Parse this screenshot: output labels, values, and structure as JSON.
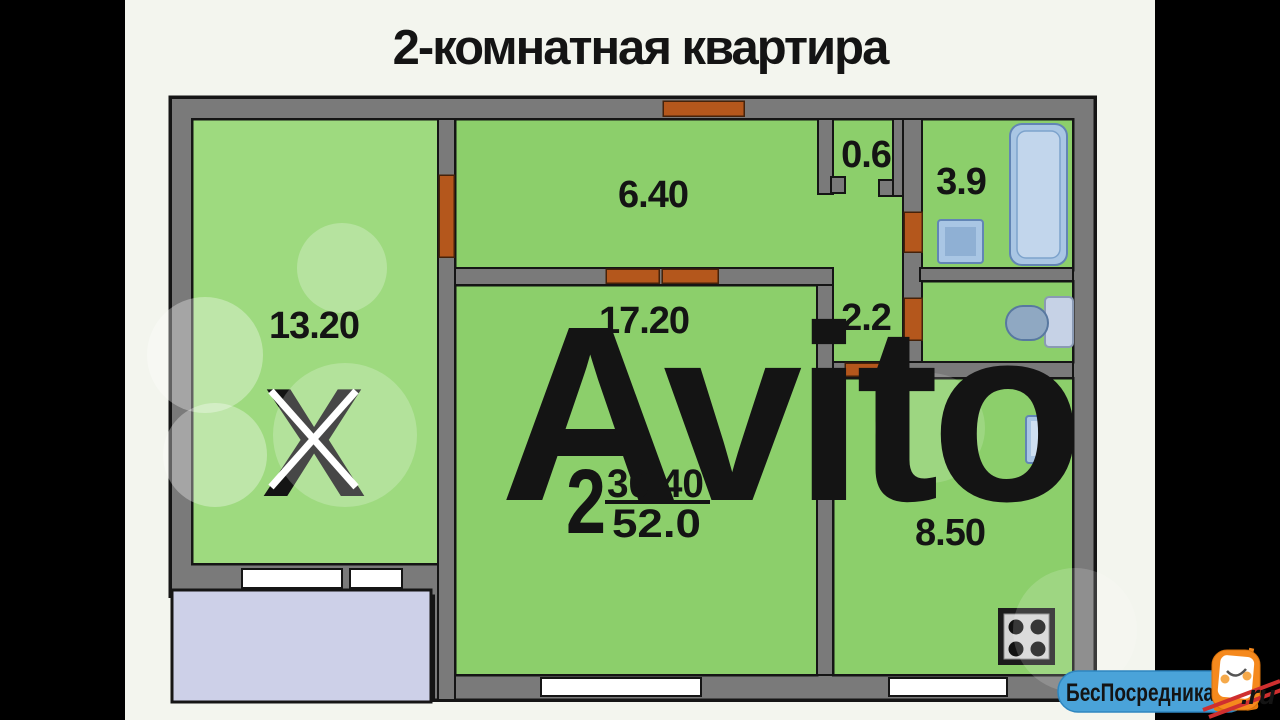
{
  "title": "2-комнатная квартира",
  "plan": {
    "rooms": {
      "living_room_1": {
        "label": "13.20"
      },
      "hallway": {
        "label": "6.40"
      },
      "living_room_2": {
        "label": "17.20"
      },
      "closet": {
        "label": "0.6"
      },
      "bathroom": {
        "label": "3.9"
      },
      "wc": {
        "label": "2.2"
      },
      "kitchen": {
        "label": "8.50"
      }
    },
    "summary": {
      "rooms_count": "2",
      "living_area": "30.40",
      "total_area": "52.0"
    }
  },
  "watermark": {
    "text": "Avito"
  },
  "logo": {
    "site_name": "БесПосредника",
    "domain_suffix": ".ru"
  },
  "colors": {
    "room_green": "#8ccf6b",
    "room_green_light": "#9eda7f",
    "wall_gray": "#7a7a7a",
    "outline_black": "#151515",
    "door_orange": "#b4571c",
    "window_white": "#ffffff",
    "balcony_lavender": "#cdd0e8",
    "fixture_blue": "#a9c6e4",
    "x_mark_red": "#c5402a",
    "logo_blue": "#4aa3d9",
    "mascot_orange": "#f5891d",
    "background": "#f3f5ee"
  }
}
